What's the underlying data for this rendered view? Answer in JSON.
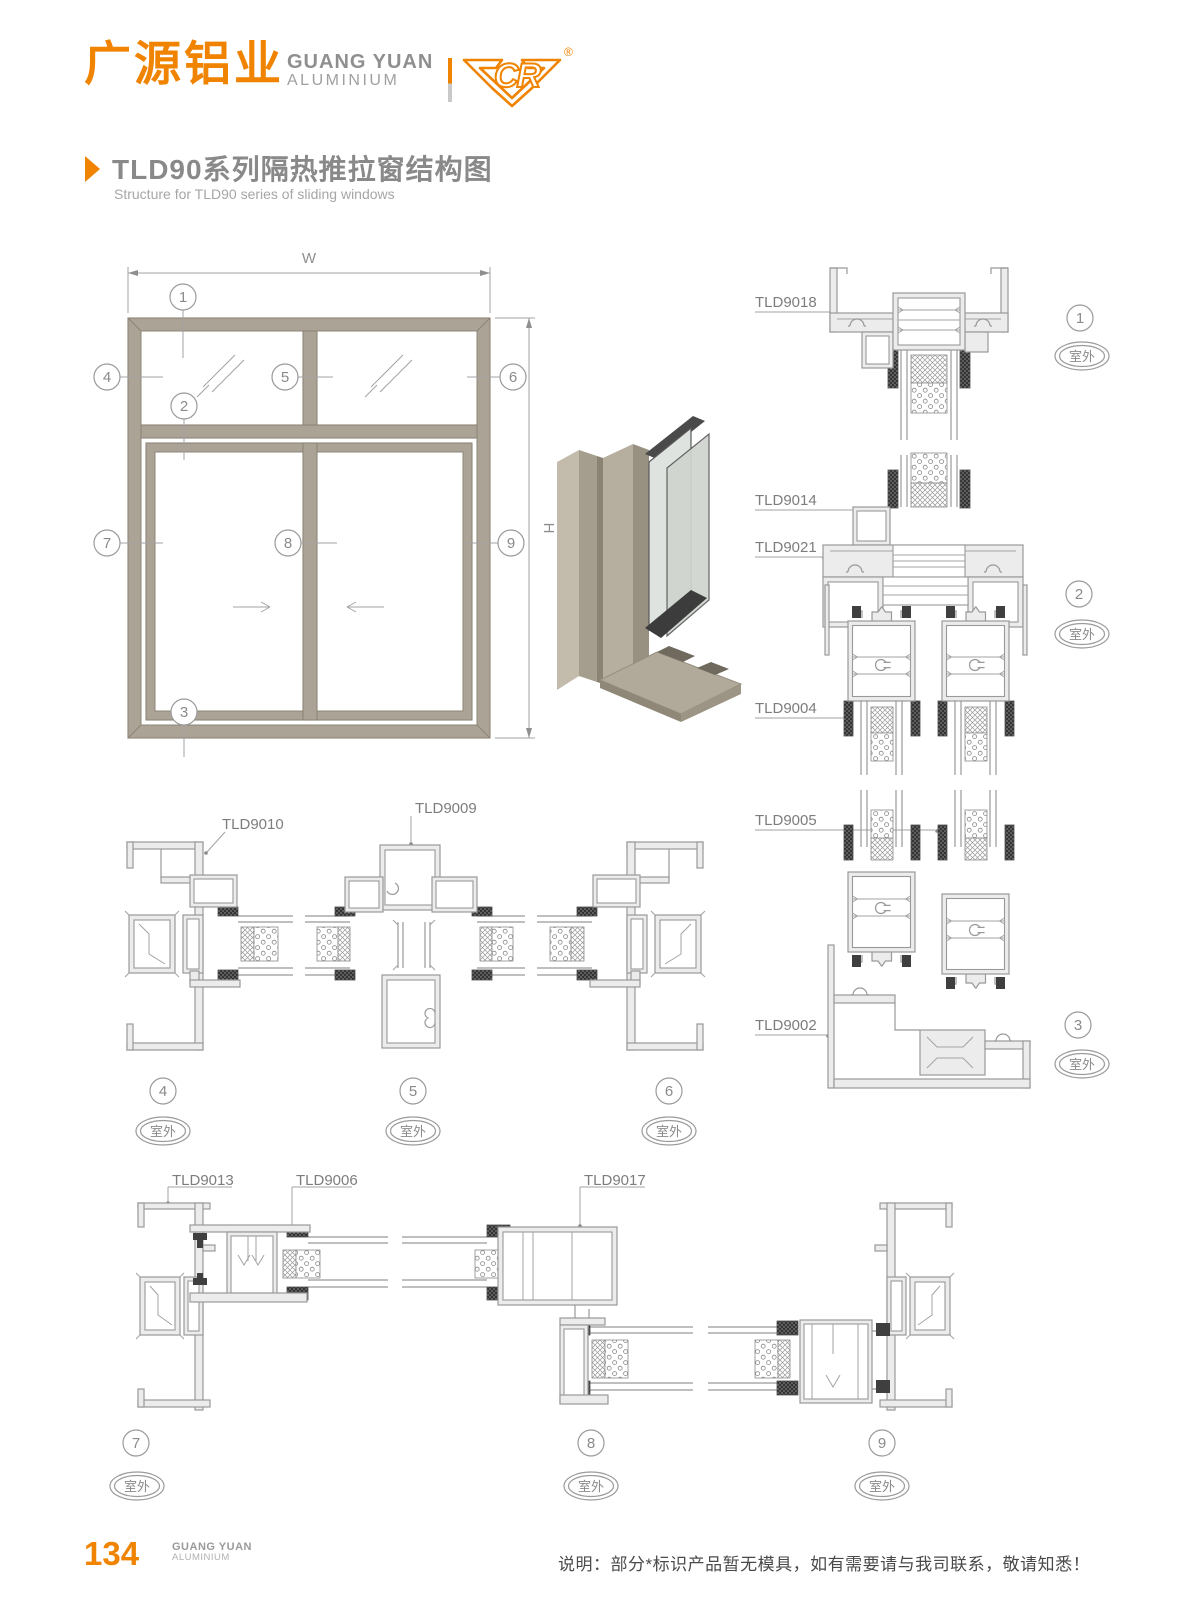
{
  "header": {
    "brand_cn": "广源铝业",
    "brand_en1": "GUANG YUAN",
    "brand_en2": "ALUMINIUM",
    "logo_letters": "CR",
    "registered": "®"
  },
  "title": {
    "cn": "TLD90系列隔热推拉窗结构图",
    "en": "Structure for TLD90 series of sliding windows"
  },
  "elevation": {
    "dim_w": "W",
    "dim_h": "H"
  },
  "labels": {
    "outdoor": "室外"
  },
  "parts": {
    "p9018": "TLD9018",
    "p9014": "TLD9014",
    "p9021": "TLD9021",
    "p9004": "TLD9004",
    "p9005": "TLD9005",
    "p9002": "TLD9002",
    "p9010": "TLD9010",
    "p9009": "TLD9009",
    "p9013": "TLD9013",
    "p9006": "TLD9006",
    "p9017": "TLD9017"
  },
  "callouts": {
    "c1": "1",
    "c2": "2",
    "c3": "3",
    "c4": "4",
    "c5": "5",
    "c6": "6",
    "c7": "7",
    "c8": "8",
    "c9": "9"
  },
  "footer": {
    "page": "134",
    "brand1": "GUANG YUAN",
    "brand2": "ALUMINIUM",
    "note": "说明：部分*标识产品暂无模具，如有需要请与我司联系，敬请知悉！"
  }
}
